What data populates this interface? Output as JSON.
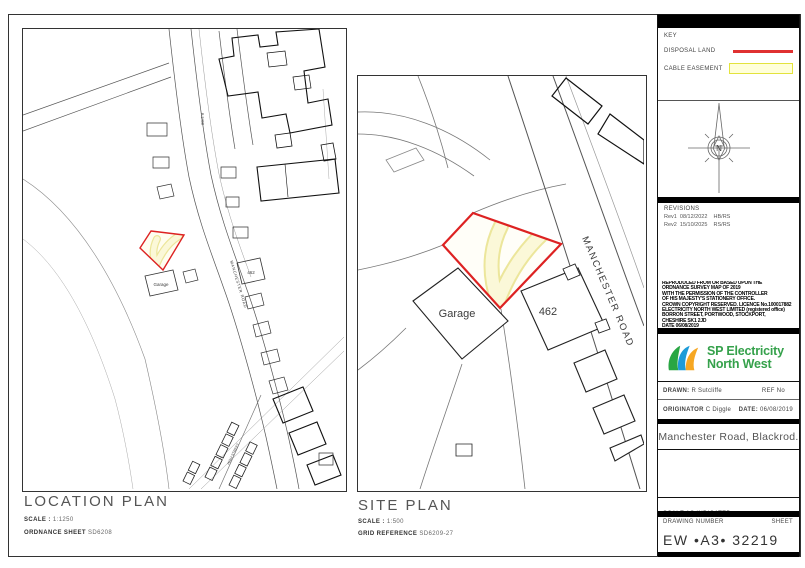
{
  "key": {
    "title": "KEY",
    "disposal_label": "DISPOSAL LAND",
    "easement_label": "CABLE EASEMENT",
    "disposal_color": "#e03131",
    "easement_fill": "#ffffd9",
    "easement_border": "#e3e33c"
  },
  "compass": {
    "north": "N"
  },
  "revisions": {
    "title": "REVISIONS",
    "row1": "Rev1  08/12/2022    HB/RS",
    "row2": "Rev2  15/10/2025    RS/RS"
  },
  "copyright": {
    "lines": [
      "REPRODUCED FROM OR BASED UPON THE",
      "ORDNANCE SURVEY MAP OF 2019",
      "WITH THE PERMISSION OF THE CONTROLLER",
      "OF HIS MAJESTY'S STATIONERY OFFICE.",
      "CROWN COPYRIGHT RESERVED. LICENCE No.100017882",
      "ELECTRICITY NORTH WEST LIMITED (registered office)",
      "BORRON STREET, PORTWOOD, STOCKPORT,",
      "CHESHIRE SK1 2JD",
      "DATE 06/08/2019"
    ]
  },
  "logo": {
    "line1": "SP Electricity",
    "line2": "North West",
    "text_color": "#35a14b",
    "leaf_green": "#29a643",
    "leaf_blue": "#1d9bd8",
    "leaf_orange": "#f6a723"
  },
  "fields": {
    "drawn_label": "DRAWN:",
    "drawn_value": "R Sutcliffe",
    "ref_label": "REF No",
    "originator_label": "ORIGINATOR",
    "originator_value": "C Diggle",
    "date_label": "DATE:",
    "date_value": "06/08/2019"
  },
  "project": {
    "title": "Manchester Road, Blackrod."
  },
  "footer": {
    "scale_note": "SCALE AS INDICATED",
    "drawing_number_label": "DRAWING NUMBER",
    "sheet_label": "SHEET",
    "drawing_number": "EW  •A3•  32219"
  },
  "location_plan": {
    "title": "LOCATION PLAN",
    "scale_label": "SCALE :",
    "scale_value": "1:1250",
    "ordnance_label": "ORDNANCE SHEET",
    "ordnance_value": "SD6208",
    "labels": {
      "garage": "Garage",
      "house": "462",
      "road": "MANCHESTER ROAD",
      "road_number": "B 5408",
      "street": "HIGH STREET"
    }
  },
  "site_plan": {
    "title": "SITE PLAN",
    "scale_label": "SCALE :",
    "scale_value": "1:500",
    "grid_label": "GRID REFERENCE",
    "grid_value": "SD6209-27",
    "labels": {
      "garage": "Garage",
      "house": "462",
      "road": "MANCHESTER ROAD"
    }
  }
}
